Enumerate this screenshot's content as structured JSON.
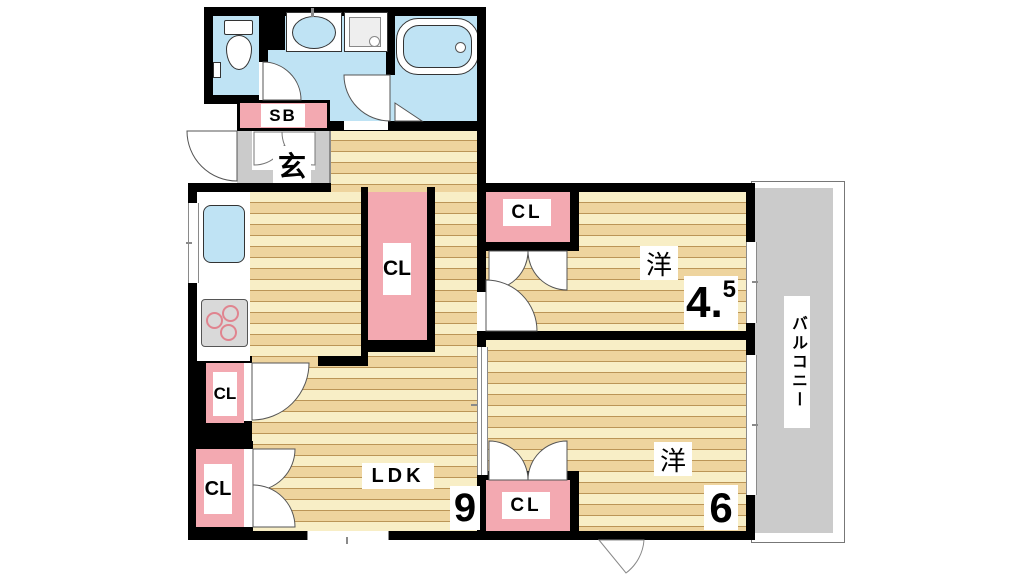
{
  "plan": {
    "entrance": {
      "shoe_box": "SB",
      "genkan": "玄"
    },
    "closet": "CL",
    "ldk": {
      "label": "LDK",
      "size": "9"
    },
    "western_room_1": {
      "label": "洋",
      "size": "4.",
      "size_sup": "5"
    },
    "western_room_2": {
      "label": "洋",
      "size": "6"
    },
    "balcony": {
      "label": "バルコニー"
    }
  },
  "colors": {
    "wall": "#000000",
    "closet_pink": "#f3a9b1",
    "water_blue": "#bfe3f4",
    "tile_grey": "#cbcbcb",
    "wood_light": "#f8eec6",
    "wood_dark": "#eed49e"
  }
}
